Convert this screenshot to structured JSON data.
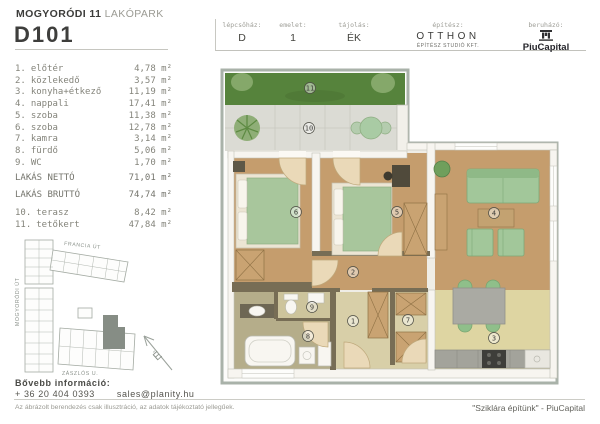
{
  "header": {
    "brand_bold": "MOGYORÓDI 11",
    "brand_light": "LAKÓPARK",
    "unit_id": "D101",
    "info": [
      {
        "label": "lépcsőház:",
        "value": "D"
      },
      {
        "label": "emelet:",
        "value": "1"
      },
      {
        "label": "tájolás:",
        "value": "ÉK"
      }
    ],
    "architect_label": "építész:",
    "architect_name": "OTTHON",
    "architect_sub": "ÉPÍTÉSZ STUDIÓ KFT.",
    "developer_label": "beruházó:",
    "developer_name": "PiuCapital"
  },
  "rooms": [
    {
      "num": "1.",
      "name": "előtér",
      "area": "4,78 m²"
    },
    {
      "num": "2.",
      "name": "közlekedő",
      "area": "3,57 m²"
    },
    {
      "num": "3.",
      "name": "konyha+étkező",
      "area": "11,19 m²"
    },
    {
      "num": "4.",
      "name": "nappali",
      "area": "17,41 m²"
    },
    {
      "num": "5.",
      "name": "szoba",
      "area": "11,38 m²"
    },
    {
      "num": "6.",
      "name": "szoba",
      "area": "12,78 m²"
    },
    {
      "num": "7.",
      "name": "kamra",
      "area": "3,14 m²"
    },
    {
      "num": "8.",
      "name": "fürdő",
      "area": "5,06 m²"
    },
    {
      "num": "9.",
      "name": "WC",
      "area": "1,70 m²"
    }
  ],
  "totals": [
    {
      "label": "LAKÁS NETTÓ",
      "value": "71,01 m²"
    },
    {
      "label": "LAKÁS BRUTTÓ",
      "value": "74,74 m²"
    }
  ],
  "outdoor": [
    {
      "num": "10.",
      "name": "terasz",
      "area": "8,42 m²"
    },
    {
      "num": "11.",
      "name": "tetőkert",
      "area": "47,84 m²"
    }
  ],
  "site_map": {
    "street_top": "FRANCIA ÚT",
    "street_left": "MOGYORÓDI ÚT",
    "street_bottom": "ZÁSZLÓS U.",
    "compass": "É"
  },
  "plan": {
    "room_labels": [
      "1",
      "2",
      "3",
      "4",
      "5",
      "6",
      "7",
      "8",
      "9",
      "10",
      "11"
    ]
  },
  "footer": {
    "info_title": "Bővebb információ:",
    "phone": "+ 36 20 404 0393",
    "email": "sales@planity.hu",
    "disclaimer": "Az ábrázolt berendezés csak illusztráció, az adatok tájékoztató jellegűek.",
    "slogan": "\"Sziklára építünk\" - PiuCapital"
  },
  "colors": {
    "plan_frame": "#a9b2a9",
    "grass_green": "#56833c",
    "terrace_gray": "#dbdbd4",
    "wood_floor": "#c59d6d",
    "khaki_floor": "#d8cfa8",
    "bath_floor": "#b5ad8a",
    "kitchen_floor": "#ded5a2",
    "furniture_green": "#a2c79a",
    "wardrobe_tan": "#c9a372",
    "dark_wall": "#776d55",
    "map_highlight": "#868d85"
  }
}
